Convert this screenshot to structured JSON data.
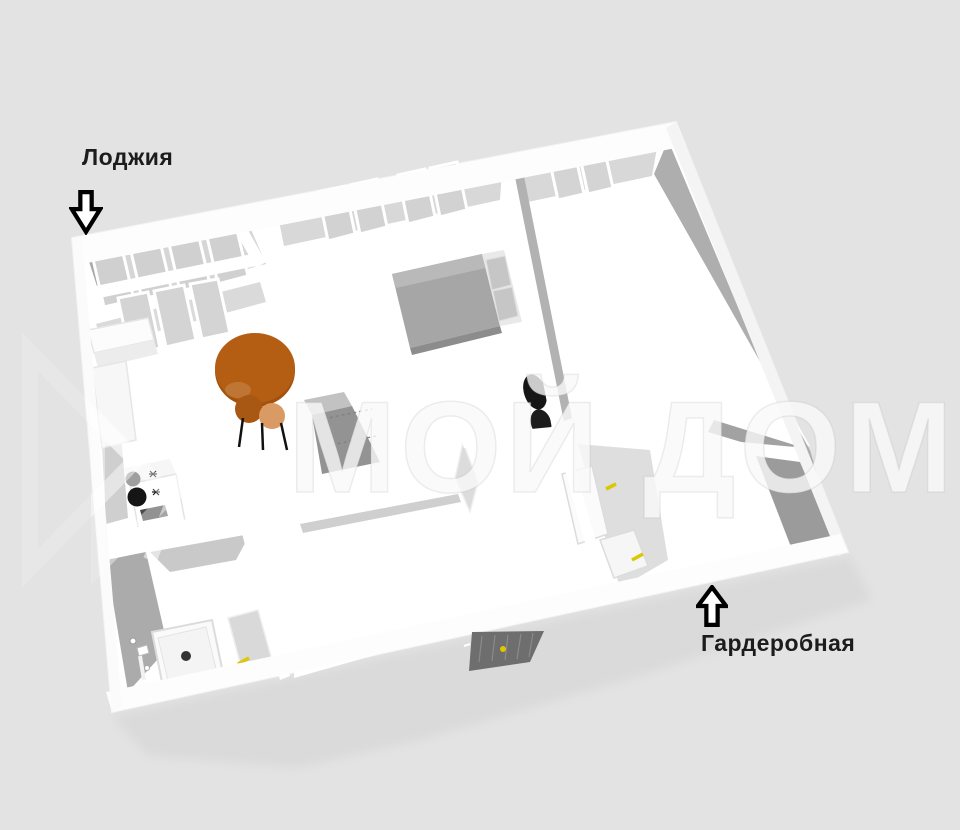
{
  "scene": {
    "type": "3d-apartment-floor-plan-render",
    "background": "#e3e3e3"
  },
  "annotations": {
    "loggia": {
      "label": "Лоджия",
      "arrow_direction": "down"
    },
    "wardrobe": {
      "label": "Гардеробная",
      "arrow_direction": "up"
    }
  },
  "watermark": {
    "text": "МОЙ ДОМ"
  },
  "colors": {
    "label_text": "#1c1c1c",
    "arrow_outline": "#000000",
    "wall_white": "#ffffff",
    "wall_shadow_gray": "#aeaeae",
    "wall_dark_gray": "#9b9b9b",
    "glass_gray": "#d2d2d2",
    "table_orange": "#b45e14",
    "chair_orange_dark": "#a85812",
    "chair_orange_light": "#d99a63",
    "bed_gray": "#a6a6a6",
    "pillow_gray": "#c6c6c6",
    "closet_gray": "#939393",
    "armchair_black": "#161616",
    "entrance_door_gray": "#6e6e6e",
    "door_handle_yellow": "#dcc700",
    "burner_black": "#151515",
    "building_shadow": "#d8d8d8"
  }
}
